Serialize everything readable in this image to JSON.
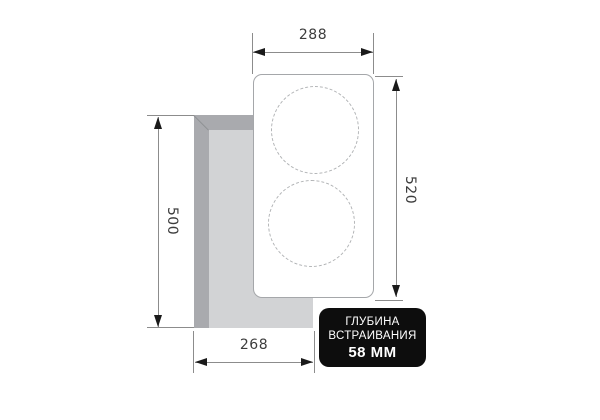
{
  "diagram": {
    "type": "built-in cooktop installation dimension drawing",
    "dimensions": {
      "top_width_mm": "288",
      "right_height_mm": "520",
      "left_height_mm": "500",
      "bottom_width_mm": "268"
    },
    "badge": {
      "line1": "ГЛУБИНА",
      "line2": "ВСТРАИВАНИЯ",
      "line3": "58 ММ"
    },
    "colors": {
      "badge_bg": "#0d0d0d",
      "badge_text": "#ffffff",
      "cutout_wall": "#a9aaae",
      "cutout_inner": "#d2d3d5",
      "dimension_line": "#8c8c8c",
      "arrowhead": "#1a1a1a",
      "dimension_text": "#3d3d3d",
      "panel_border": "#a5a7aa",
      "burner_dash": "#b2b4b6"
    }
  }
}
